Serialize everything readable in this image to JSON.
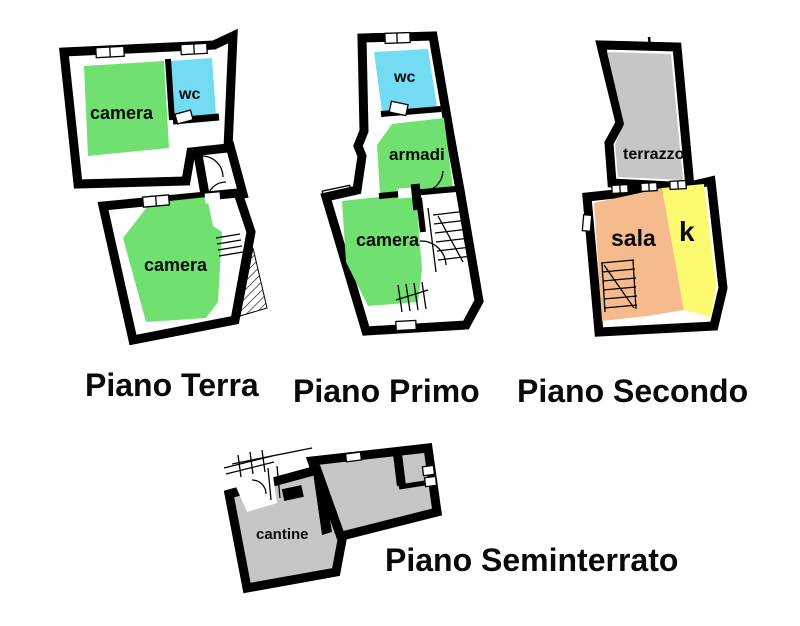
{
  "page": {
    "background": "#ffffff"
  },
  "colors": {
    "wall": "#000000",
    "green": "#70e070",
    "cyan": "#74dcf2",
    "orange": "#f6bb8c",
    "yellow": "#fcfa6e",
    "gray": "#c6c6c6",
    "white": "#ffffff",
    "label": "#0a0a0a"
  },
  "floors": [
    {
      "label": "Piano Terra",
      "rooms": [
        {
          "name": "camera",
          "color_key": "green"
        },
        {
          "name": "wc",
          "color_key": "cyan"
        },
        {
          "name": "camera",
          "color_key": "green"
        }
      ]
    },
    {
      "label": "Piano Primo",
      "rooms": [
        {
          "name": "wc",
          "color_key": "cyan"
        },
        {
          "name": "armadi",
          "color_key": "green"
        },
        {
          "name": "camera",
          "color_key": "green"
        }
      ]
    },
    {
      "label": "Piano Secondo",
      "rooms": [
        {
          "name": "terrazzo",
          "color_key": "gray"
        },
        {
          "name": "sala",
          "color_key": "orange"
        },
        {
          "name": "k",
          "color_key": "yellow"
        }
      ]
    },
    {
      "label": "Piano Seminterrato",
      "rooms": [
        {
          "name": "cantine",
          "color_key": "gray"
        }
      ]
    }
  ]
}
